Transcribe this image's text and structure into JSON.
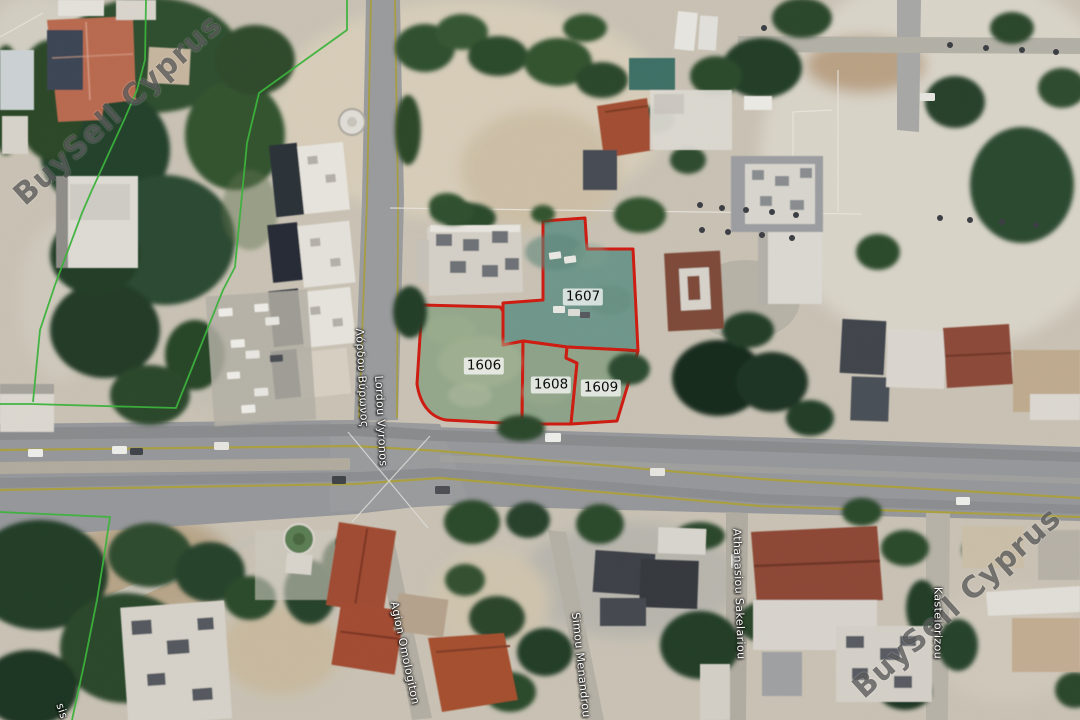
{
  "map": {
    "type": "satellite-imagery",
    "watermark": {
      "text": "BuySell Cyprus",
      "color": "#2d2d2d"
    },
    "parcels": [
      {
        "id": "1606"
      },
      {
        "id": "1607"
      },
      {
        "id": "1608"
      },
      {
        "id": "1609"
      }
    ],
    "streets": {
      "greek": "Λόρδου Βύρωνος",
      "latin": "Lordou Vyronos",
      "agion": "Agion Omologiton",
      "simou": "Simou Menandrou",
      "athanasiou": "Athanasiou Sakelariou",
      "kastelorizou": "Kastelorizou",
      "corner_fragment": "sis"
    },
    "colors": {
      "parcel_outline": "#ce1a10",
      "boundary_line": "#3ab33a",
      "road_edge_line": "#aaa041",
      "parcel_fill_teal": "#6f968a",
      "parcel_fill_green": "#94a78a"
    }
  }
}
